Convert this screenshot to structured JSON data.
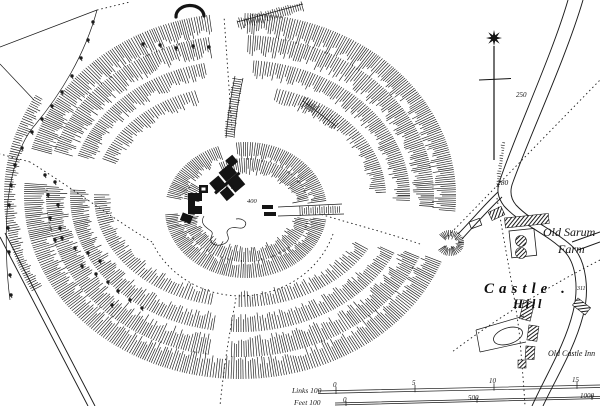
{
  "labels": {
    "farm_line1": "Old Sarum",
    "farm_line2": "Farm",
    "hill_word1": "Castle .",
    "hill_word2": "Hill",
    "inn": "Old Castle Inn",
    "keep": "KEEP"
  },
  "heights": {
    "h250": "250",
    "h280": "280",
    "h311": "311",
    "h400": "400"
  },
  "scales": {
    "links": {
      "title": "Links 100",
      "t0": "0",
      "t1": "5",
      "t2": "10",
      "t3": "15"
    },
    "feet": {
      "title": "Feet 100",
      "t0": "0",
      "t1": "500",
      "t2": "1000"
    }
  },
  "icons": {
    "north_arrow": "north-star-arrow"
  },
  "colors": {
    "ink": "#1b1b1b",
    "paper": "#ffffff"
  }
}
